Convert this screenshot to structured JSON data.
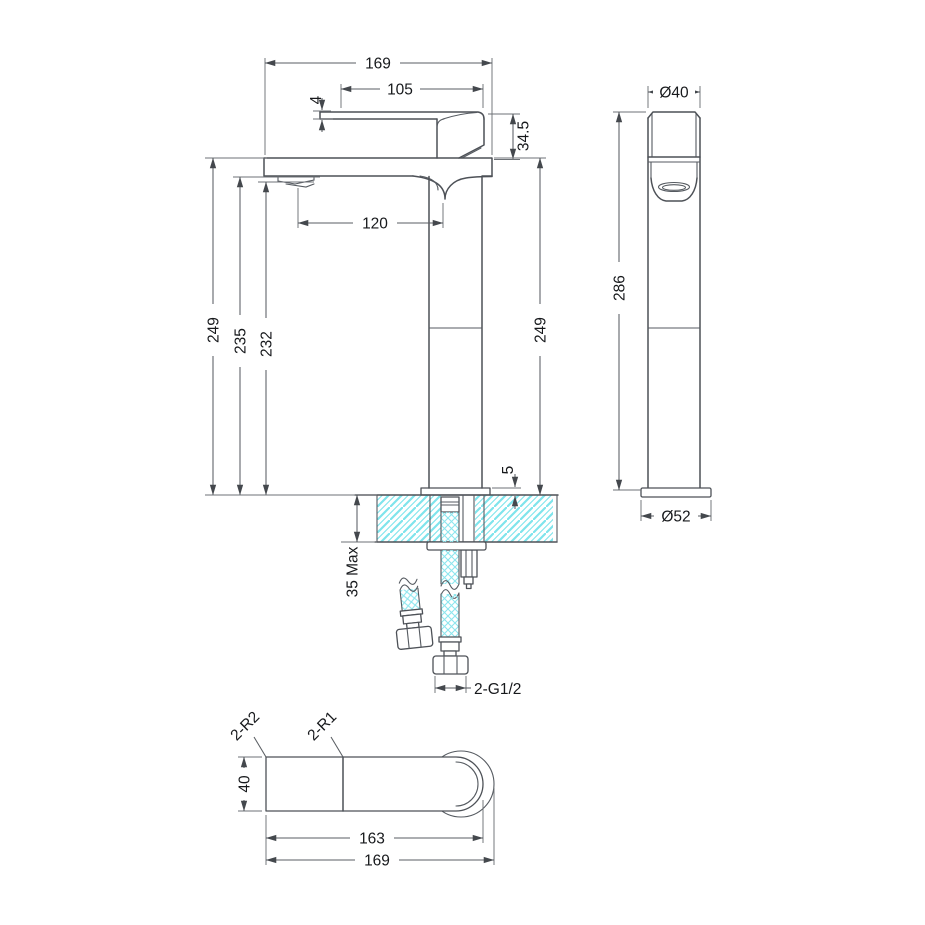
{
  "drawing_type": "faucet-technical-drawing",
  "colors": {
    "line": "#4d5157",
    "hatch": "#7ee4ec",
    "braid": "#8ce6ee",
    "text": "#17191c"
  },
  "labels": {
    "front": {
      "width_total": "169",
      "lever_length": "105",
      "lever_thickness": "4",
      "head_height": "34.5",
      "spout_reach": "120",
      "height_left": "249",
      "spout_height": "235",
      "aerator_height": "232",
      "height_right": "249",
      "base_plate_thickness": "5",
      "counter_thickness": "35 Max",
      "thread_size": "2-G1/2"
    },
    "side": {
      "top_diameter": "Ø40",
      "total_height": "286",
      "base_diameter": "Ø52"
    },
    "plan": {
      "outer_radius": "2-R2",
      "inner_radius": "2-R1",
      "body_width": "40",
      "inner_length": "163",
      "total_length": "169"
    }
  }
}
